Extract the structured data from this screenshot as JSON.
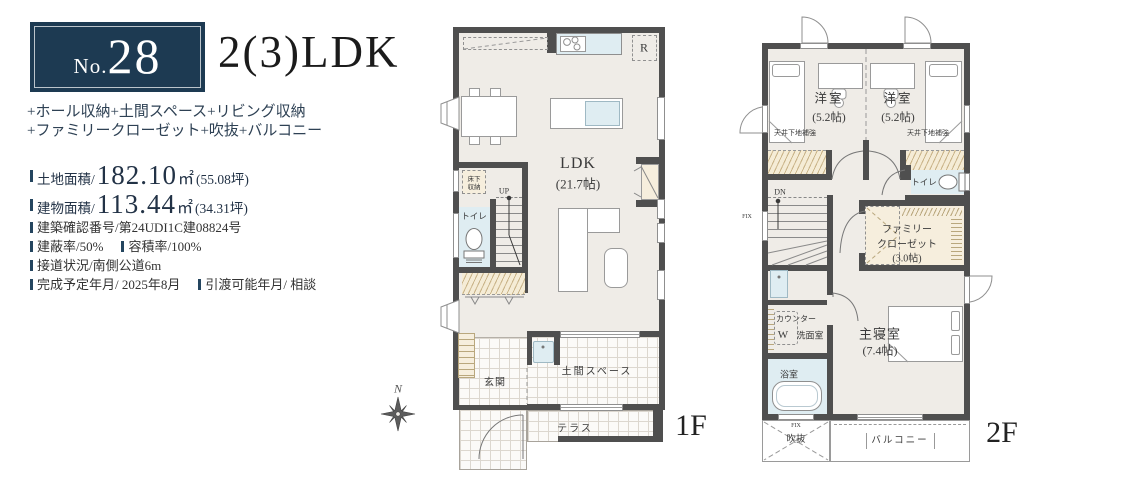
{
  "panel": {
    "badge_prefix": "No.",
    "badge_number": "28",
    "title": "2(3)LDK",
    "feature_line1": "+ホール収納+土間スペース+リビング収納",
    "feature_line2": "+ファミリークローゼット+吹抜+バルコニー",
    "land_label": "土地面積/",
    "land_value": "182.10",
    "land_unit": "㎡",
    "land_tsubo": "(55.08坪)",
    "bldg_label": "建物面積/",
    "bldg_value": "113.44",
    "bldg_unit": "㎡",
    "bldg_tsubo": "(34.31坪)",
    "detail_row1": "建築確認番号/第24UDI1C建08824号",
    "detail_row2a": "建蔽率/50%",
    "detail_row2b": "容積率/100%",
    "detail_row3": "接道状況/南側公道6m",
    "detail_row4a": "完成予定年月/ 2025年8月",
    "detail_row4b": "引渡可能年月/ 相談"
  },
  "compass_n": "N",
  "f1": {
    "tag": "1F",
    "ldk": "LDK",
    "ldk_size": "(21.7帖)",
    "fridge": "R",
    "underfloor_1": "床下",
    "underfloor_2": "収納",
    "toilet": "トイレ",
    "up": "UP",
    "genkan": "玄関",
    "doma": "土間スペース",
    "terrace": "テラス"
  },
  "f2": {
    "tag": "2F",
    "room_left": "洋室",
    "room_left_size": "(5.2帖)",
    "room_right": "洋室",
    "room_right_size": "(5.2帖)",
    "ceiling_left": "天井下地補強",
    "ceiling_right": "天井下地補強",
    "toilet": "トイレ",
    "dn": "DN",
    "fix_left": "FIX",
    "fc_line1": "ファミリー",
    "fc_line2": "クローゼット",
    "fc_line3": "(3.0帖)",
    "counter": "カウンター",
    "washer": "W",
    "senmen": "洗面室",
    "bath": "浴室",
    "master": "主寝室",
    "master_size": "(7.4帖)",
    "fix_bottom": "FIX",
    "void": "吹抜",
    "balcony": "バルコニー"
  },
  "colors": {
    "navy": "#1d3a52",
    "wall": "#4f4f4f",
    "floor": "#efece7",
    "closet_cream": "#f6eedd",
    "water_aqua": "#dfedf2"
  }
}
